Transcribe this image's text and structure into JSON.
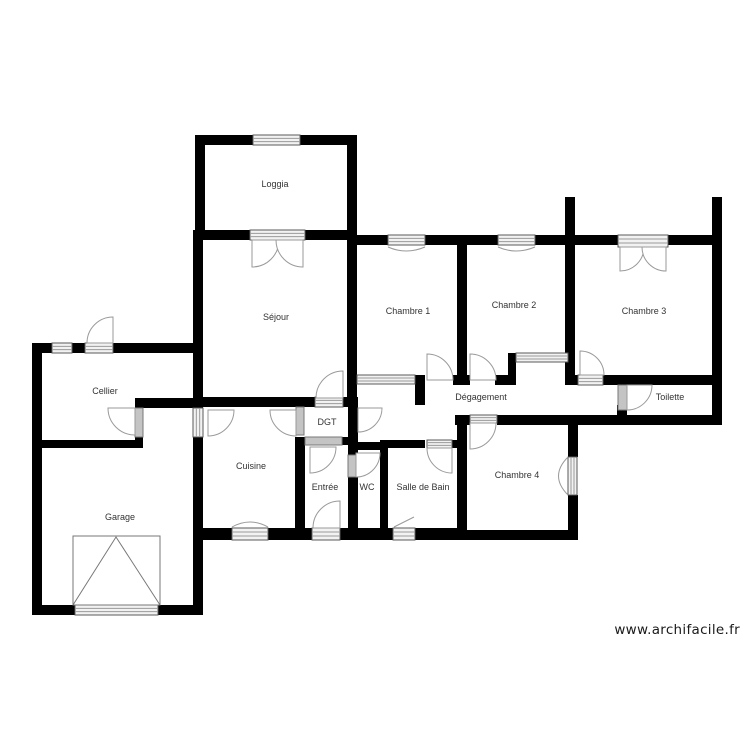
{
  "watermark": "www.archifacile.fr",
  "plan": {
    "canvas": {
      "w": 750,
      "h": 750,
      "bg": "#ffffff"
    },
    "colors": {
      "wall": "#000000",
      "window_fill": "#f2f2f2",
      "window_stroke": "#5a5a5a",
      "window_line": "#9a9a9a",
      "bar_fill": "#c4c4c4",
      "bar_stroke": "#777777",
      "door_stroke": "#9a9a9a",
      "door_fill": "#ffffff",
      "label": "#333333",
      "watermark": "#1a1a1a"
    },
    "rooms": [
      {
        "id": "loggia",
        "name": "Loggia",
        "x": 275,
        "y": 187
      },
      {
        "id": "sejour",
        "name": "Séjour",
        "x": 276,
        "y": 320
      },
      {
        "id": "chambre-1",
        "name": "Chambre 1",
        "x": 408,
        "y": 314
      },
      {
        "id": "chambre-2",
        "name": "Chambre 2",
        "x": 514,
        "y": 308
      },
      {
        "id": "chambre-3",
        "name": "Chambre 3",
        "x": 644,
        "y": 314
      },
      {
        "id": "cellier",
        "name": "Cellier",
        "x": 105,
        "y": 394
      },
      {
        "id": "degagement",
        "name": "Dégagement",
        "x": 481,
        "y": 400
      },
      {
        "id": "toilette",
        "name": "Toilette",
        "x": 670,
        "y": 400
      },
      {
        "id": "dgt",
        "name": "DGT",
        "x": 327,
        "y": 425
      },
      {
        "id": "cuisine",
        "name": "Cuisine",
        "x": 251,
        "y": 469
      },
      {
        "id": "entree",
        "name": "Entrée",
        "x": 325,
        "y": 490
      },
      {
        "id": "wc",
        "name": "WC",
        "x": 367,
        "y": 490
      },
      {
        "id": "salle-de-bain",
        "name": "Salle de Bain",
        "x": 423,
        "y": 490
      },
      {
        "id": "chambre-4",
        "name": "Chambre 4",
        "x": 517,
        "y": 478
      },
      {
        "id": "garage",
        "name": "Garage",
        "x": 120,
        "y": 520
      }
    ],
    "walls": [
      [
        195,
        135,
        58,
        10
      ],
      [
        300,
        135,
        57,
        10
      ],
      [
        195,
        135,
        10,
        105
      ],
      [
        347,
        135,
        10,
        105
      ],
      [
        195,
        230,
        55,
        10
      ],
      [
        305,
        230,
        52,
        10
      ],
      [
        347,
        235,
        41,
        10
      ],
      [
        425,
        235,
        73,
        10
      ],
      [
        535,
        235,
        83,
        10
      ],
      [
        668,
        235,
        54,
        10
      ],
      [
        565,
        197,
        10,
        45
      ],
      [
        712,
        197,
        10,
        228
      ],
      [
        193,
        230,
        10,
        310
      ],
      [
        347,
        230,
        10,
        175
      ],
      [
        457,
        240,
        10,
        145
      ],
      [
        565,
        240,
        10,
        145
      ],
      [
        415,
        375,
        10,
        30
      ],
      [
        453,
        375,
        17,
        10
      ],
      [
        495,
        375,
        21,
        10
      ],
      [
        568,
        375,
        10,
        10
      ],
      [
        603,
        375,
        109,
        10
      ],
      [
        508,
        353,
        8,
        32
      ],
      [
        455,
        415,
        15,
        10
      ],
      [
        497,
        415,
        215,
        10
      ],
      [
        617,
        405,
        10,
        14
      ],
      [
        457,
        415,
        10,
        125
      ],
      [
        568,
        415,
        10,
        42
      ],
      [
        568,
        495,
        10,
        45
      ],
      [
        457,
        530,
        120,
        10
      ],
      [
        193,
        397,
        122,
        10
      ],
      [
        343,
        397,
        15,
        10
      ],
      [
        295,
        437,
        10,
        103
      ],
      [
        342,
        437,
        16,
        8
      ],
      [
        348,
        405,
        10,
        50
      ],
      [
        348,
        477,
        10,
        63
      ],
      [
        348,
        442,
        40,
        8
      ],
      [
        380,
        442,
        8,
        98
      ],
      [
        380,
        440,
        45,
        8
      ],
      [
        452,
        440,
        15,
        8
      ],
      [
        193,
        528,
        39,
        12
      ],
      [
        268,
        528,
        44,
        12
      ],
      [
        340,
        528,
        53,
        12
      ],
      [
        415,
        528,
        52,
        12
      ],
      [
        32,
        343,
        20,
        10
      ],
      [
        72,
        343,
        13,
        10
      ],
      [
        113,
        343,
        80,
        10
      ],
      [
        32,
        343,
        10,
        272
      ],
      [
        135,
        398,
        68,
        10
      ],
      [
        135,
        437,
        8,
        11
      ],
      [
        32,
        440,
        111,
        8
      ],
      [
        193,
        540,
        10,
        75
      ],
      [
        32,
        605,
        43,
        10
      ],
      [
        158,
        605,
        45,
        10
      ]
    ],
    "windows": [
      [
        253,
        135,
        47,
        10
      ],
      [
        250,
        230,
        55,
        10
      ],
      [
        388,
        235,
        37,
        10
      ],
      [
        498,
        235,
        37,
        10
      ],
      [
        618,
        235,
        50,
        12
      ],
      [
        357,
        375,
        58,
        9
      ],
      [
        516,
        353,
        52,
        9
      ],
      [
        578,
        375,
        25,
        10
      ],
      [
        315,
        397,
        28,
        10
      ],
      [
        52,
        343,
        20,
        10
      ],
      [
        85,
        343,
        28,
        10
      ],
      [
        193,
        408,
        10,
        29
      ],
      [
        232,
        528,
        36,
        12
      ],
      [
        312,
        528,
        28,
        12
      ],
      [
        393,
        528,
        22,
        12
      ],
      [
        427,
        440,
        25,
        8
      ],
      [
        470,
        415,
        27,
        8
      ],
      [
        568,
        457,
        9,
        38
      ],
      [
        75,
        605,
        83,
        10
      ]
    ],
    "bars": [
      [
        135,
        408,
        8,
        29
      ],
      [
        296,
        407,
        8,
        28
      ],
      [
        305,
        437,
        37,
        8
      ],
      [
        348,
        455,
        8,
        22
      ],
      [
        618,
        385,
        9,
        25
      ]
    ],
    "doors": [
      [
        252,
        240,
        27,
        90,
        0
      ],
      [
        303,
        240,
        27,
        90,
        180
      ],
      [
        620,
        247,
        24,
        90,
        0
      ],
      [
        666,
        247,
        24,
        90,
        180
      ],
      [
        343,
        398,
        27,
        270,
        180
      ],
      [
        427,
        380,
        26,
        270,
        0
      ],
      [
        470,
        380,
        26,
        270,
        0
      ],
      [
        580,
        375,
        24,
        270,
        0
      ],
      [
        627,
        385,
        25,
        90,
        0
      ],
      [
        358,
        408,
        24,
        0,
        90
      ],
      [
        208,
        410,
        26,
        90,
        0
      ],
      [
        296,
        410,
        26,
        90,
        180
      ],
      [
        113,
        343,
        26,
        270,
        180
      ],
      [
        135,
        408,
        27,
        90,
        180
      ],
      [
        310,
        447,
        26,
        90,
        0
      ],
      [
        340,
        528,
        27,
        270,
        180
      ],
      [
        356,
        453,
        24,
        90,
        0
      ],
      [
        452,
        448,
        25,
        90,
        180
      ],
      [
        470,
        423,
        26,
        90,
        0
      ]
    ],
    "curves": [
      "M388,247 Q406,255 425,247",
      "M498,247 Q516,255 535,247",
      "M232,527 Q250,517 268,527",
      "M394,527 L414,517",
      "M568,495 Q549,476 568,457"
    ],
    "garage_door": {
      "rect": [
        73,
        536,
        87,
        69
      ],
      "lines": "M73,605 L116,537 L160,605"
    }
  }
}
